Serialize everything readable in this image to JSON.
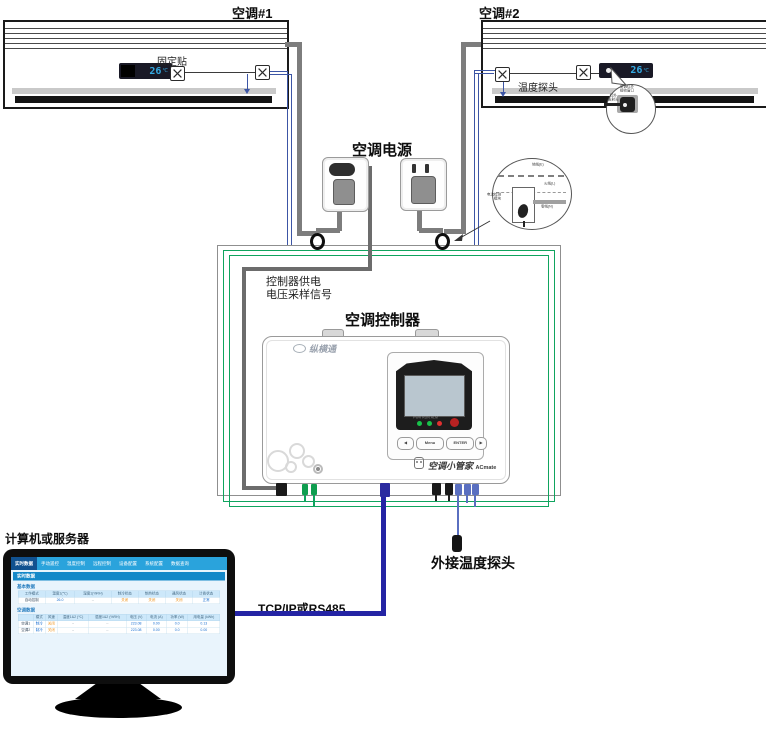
{
  "labels": {
    "ac1": "空调#1",
    "ac2": "空调#2",
    "fixed_sticker": "固定贴",
    "temp_probe": "温度探头",
    "ac_power": "空调电源",
    "ctrl_supply_line1": "控制器供电",
    "ctrl_supply_line2": "电压采样信号",
    "controller_title": "空调控制器",
    "computer": "计算机或服务器",
    "tcpip": "TCP/IP或RS485",
    "ext_temp_probe": "外接温度探头"
  },
  "ac_display": {
    "value": "26",
    "unit": "℃"
  },
  "callout_ir": {
    "top_line1": "空调红外",
    "top_line2": "接收窗口",
    "side_line1": "红外",
    "side_line2": "发射头"
  },
  "callout_power": {
    "ground": "地线(E)",
    "live": "火线(L)",
    "neutral": "零线(N)",
    "module_line1": "电流检测",
    "module_line2": "模块"
  },
  "controller": {
    "brand": "纵横通",
    "led_labels": [
      "PWR",
      "RUN",
      "ALM"
    ],
    "buttons": [
      "◀",
      "Menu",
      "ENTER",
      "▶"
    ],
    "product": "空调小管家",
    "product_en": "ACmate"
  },
  "monitor_ui": {
    "tabs": [
      {
        "label": "实时数据",
        "active": true
      },
      {
        "label": "手动遥控",
        "active": false
      },
      {
        "label": "温度控制",
        "active": false
      },
      {
        "label": "远程控制",
        "active": false
      },
      {
        "label": "设备配置",
        "active": false
      },
      {
        "label": "系统配置",
        "active": false
      },
      {
        "label": "数据查询",
        "active": false
      }
    ],
    "section_title": "实时数据",
    "basic_title": "基本数据",
    "basic_headers": [
      "工作模式",
      "温度1(℃)",
      "湿度1(%RH)",
      "制冷状态",
      "制热状态",
      "通风状态",
      "计费状态"
    ],
    "basic_row": [
      "自动控制",
      "26.0",
      "--",
      "关闭",
      "关闭",
      "关闭",
      "正常"
    ],
    "ac_title": "空调数据",
    "ac_headers": [
      "",
      "模式",
      "风速",
      "温度1&2 (℃)",
      "湿度1&2 (%RH)",
      "电压 (V)",
      "电流 (A)",
      "功率 (W)",
      "用电量 (kWh)"
    ],
    "ac_rows": [
      [
        "空调1",
        "制冷",
        "关闭",
        "--",
        "--",
        "223.08",
        "0.00",
        "0.0",
        "0.13"
      ],
      [
        "空调2",
        "制冷",
        "关闭",
        "--",
        "--",
        "223.08",
        "0.00",
        "0.0",
        "0.00"
      ]
    ]
  },
  "colors": {
    "wire_power_gray": "#7d7d7d",
    "wire_signal_navy": "#3c55a5",
    "wire_tcp_blue": "#2424a4",
    "wire_ct_green": "#0fa45e",
    "display_digit_blue": "#35aae3",
    "monitor_nav_blue": "#2aa3dc",
    "value_orange": "#f0941e",
    "value_blue": "#1a6fd0"
  }
}
